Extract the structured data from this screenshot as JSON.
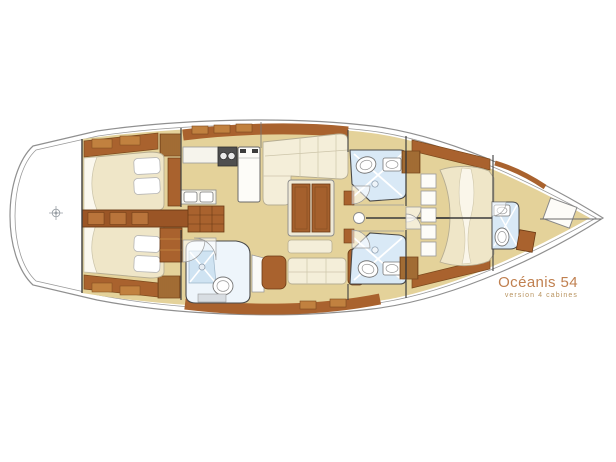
{
  "plan": {
    "title": "Océanis 54",
    "subtitle": "version 4 cabines"
  },
  "colors": {
    "background": "#ffffff",
    "title_text": "#c08050",
    "subtitle_text": "#b8935f",
    "hull_line": "#909090",
    "floor_tan": "#e4d29a",
    "wood_brown": "#a9622e",
    "wood_light": "#c1813f",
    "wood_dark": "#6b3a14",
    "upholstery_cream": "#f4eed9",
    "mattress_cream": "#efe6c8",
    "bathroom_blue": "#cfe3f2",
    "fixture_white": "#ffffff",
    "fixture_outline": "#888888"
  },
  "icons": [
    "compass-icon",
    "stove-icon",
    "sink-icon",
    "toilet-icon",
    "shower-icon",
    "mast-step-icon"
  ]
}
